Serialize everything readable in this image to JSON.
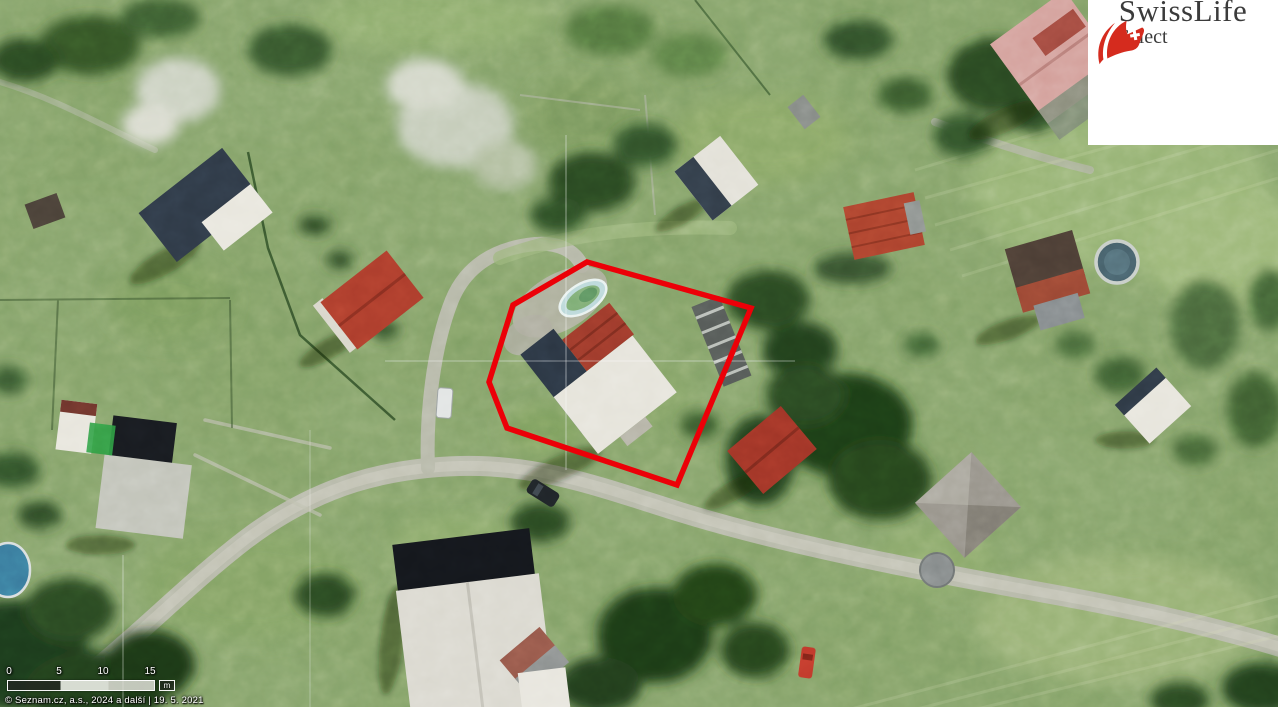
{
  "watermark": {
    "brand": "SwissLife",
    "product": "Select"
  },
  "map": {
    "parcel": {
      "points": "587,262 751,308 677,485 507,428 489,382 513,305",
      "outline_color": "#ec0008"
    },
    "scale": {
      "labels": [
        "0",
        "5",
        "10",
        "15"
      ],
      "unit": "m"
    },
    "attribution": "© Seznam.cz, a.s., 2024 a další | 19. 5. 2021"
  },
  "colors": {
    "brand_red": "#d52b1e",
    "logo_text": "#3b3b3b"
  }
}
